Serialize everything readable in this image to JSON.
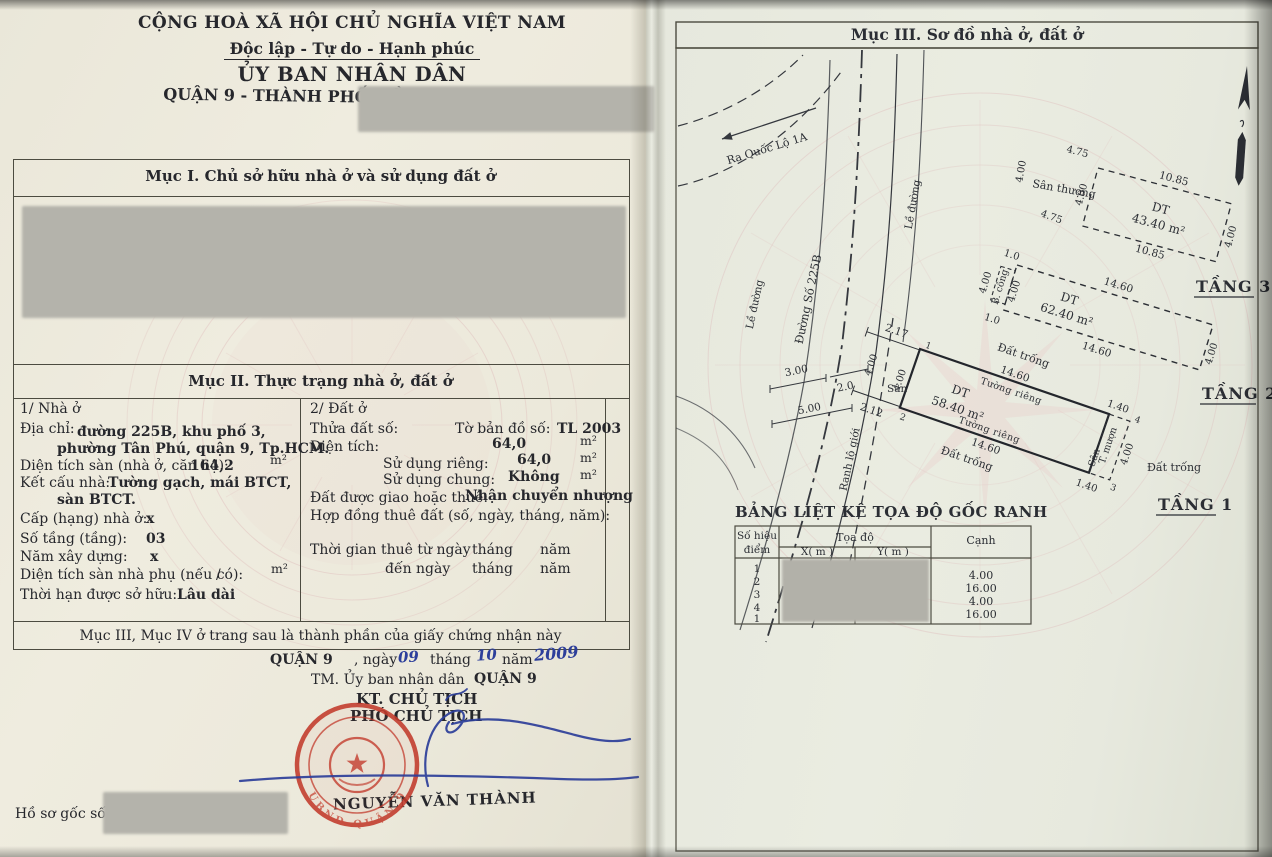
{
  "colors": {
    "seal_red": "#c23a2b",
    "pen_blue": "#2d3f9b",
    "watermark_pink": "#dfb9b9",
    "paper": "#ece9db",
    "redaction_gray": "#b4b3ab",
    "ink": "#26272c"
  },
  "left_page": {
    "header": {
      "national": "CỘNG HOÀ XÃ HỘI CHỦ NGHĨA VIỆT NAM",
      "motto": "Độc lập - Tự do - Hạnh phúc",
      "committee": "ỦY BAN NHÂN DÂN",
      "district": "QUẬN 9 - THÀNH PHỐ HỒ CHÍ MINH"
    },
    "section1_title": "Mục I. Chủ sở hữu nhà ở và sử dụng đất ở",
    "section2": {
      "title": "Mục II. Thực trạng nhà ở, đất ở",
      "house": {
        "heading": "1/ Nhà ở",
        "address_label": "Địa chỉ:",
        "address_line1": "đường 225B, khu phố 3,",
        "address_line2": "phường Tân Phú, quận 9, Tp.HCM.",
        "floor_area_label": "Diện tích sàn (nhà ở, căn hộ):",
        "floor_area_value": "164,2",
        "unit_m2": "m²",
        "structure_label": "Kết cấu nhà:",
        "structure_value1": "Tường gạch, mái BTCT,",
        "structure_value2": "sàn BTCT.",
        "grade_label": "Cấp (hạng) nhà ở:",
        "grade_value": "x",
        "floors_label": "Số tầng (tầng):",
        "floors_value": "03",
        "year_label": "Năm xây dựng:",
        "year_value": "x",
        "aux_area_label": "Diện tích sàn nhà phụ (nếu có):",
        "aux_area_value": "/",
        "tenure_label": "Thời hạn được sở hữu:",
        "tenure_value": "Lâu dài"
      },
      "land": {
        "heading": "2/ Đất ở",
        "parcel_label": "Thửa đất số:",
        "map_label": "Tờ bản đồ số:",
        "map_value": "TL 2003",
        "area_label": "Diện tích:",
        "area_value": "64,0",
        "unit_m2": "m²",
        "private_label": "Sử dụng riêng:",
        "private_value": "64,0",
        "shared_label": "Sử dụng chung:",
        "shared_value": "Không",
        "origin_label": "Đất được giao hoặc thuê:",
        "origin_value": "Nhận chuyển nhượng",
        "contract_label": "Hợp đồng thuê đất (số, ngày, tháng, năm):",
        "lease_from_label": "Thời gian thuê từ ngày",
        "lease_to_label": "đến ngày",
        "month_label": "tháng",
        "year_label": "năm"
      }
    },
    "footer_note": "Mục III, Mục IV ở trang sau là thành phần của giấy chứng nhận này",
    "signing": {
      "place": "QUẬN 9",
      "ngay_label": ", ngày",
      "day": "09",
      "thang_label": "tháng",
      "month": "10",
      "nam_label": "năm",
      "year": "2009",
      "onbehalf": "TM. Ủy ban nhân dân",
      "onbehalf_place": "QUẬN 9",
      "kt_line": "KT. CHỦ TỊCH",
      "deputy_line": "PHÓ CHỦ TỊCH",
      "signer": "NGUYỄN VĂN THÀNH",
      "seal_text": "UBND QUẬN 9"
    },
    "dossier_label": "Hồ sơ gốc số"
  },
  "right_page": {
    "title": "Mục III. Sơ đồ nhà ở, đất ở",
    "diagram": {
      "exit_label": "Ra Quốc Lộ 1A",
      "sidewalk": "Lề đường",
      "street": "Đường Số 225B",
      "road_boundary": "Ranh lộ giới",
      "vacant": "Đất trống",
      "yard": "Sân",
      "terrace": "Sân thượng",
      "balcony": "B. công",
      "private_wall": "Tường riêng",
      "borrowed_wall": "T. mượn",
      "dt": "DT",
      "floor1": {
        "area": "58.40 m²",
        "label": "TẦNG 1"
      },
      "floor2": {
        "area": "62.40 m²",
        "label": "TẦNG 2"
      },
      "floor3": {
        "area": "43.40 m²",
        "label": "TẦNG 3"
      },
      "dims": {
        "d10": "1.0",
        "d20": "2.0",
        "d140": "1.40",
        "d212": "2.12",
        "d217": "2.17",
        "d300": "3.00",
        "d400": "4.00",
        "d475": "4.75",
        "d500": "5.00",
        "d1085": "10.85",
        "d1460": "14.60"
      },
      "corners": [
        "1",
        "2",
        "3",
        "4"
      ]
    },
    "table": {
      "title": "BẢNG LIỆT KÊ TỌA ĐỘ GỐC RANH",
      "col_point_line1": "Số hiệu",
      "col_point_line2": "điểm",
      "col_coord": "Tọa độ",
      "col_x": "X( m )",
      "col_y": "Y( m )",
      "col_edge": "Cạnh",
      "points": [
        "1",
        "2",
        "3",
        "4",
        "1"
      ],
      "edges": [
        "4.00",
        "16.00",
        "4.00",
        "16.00"
      ]
    }
  }
}
